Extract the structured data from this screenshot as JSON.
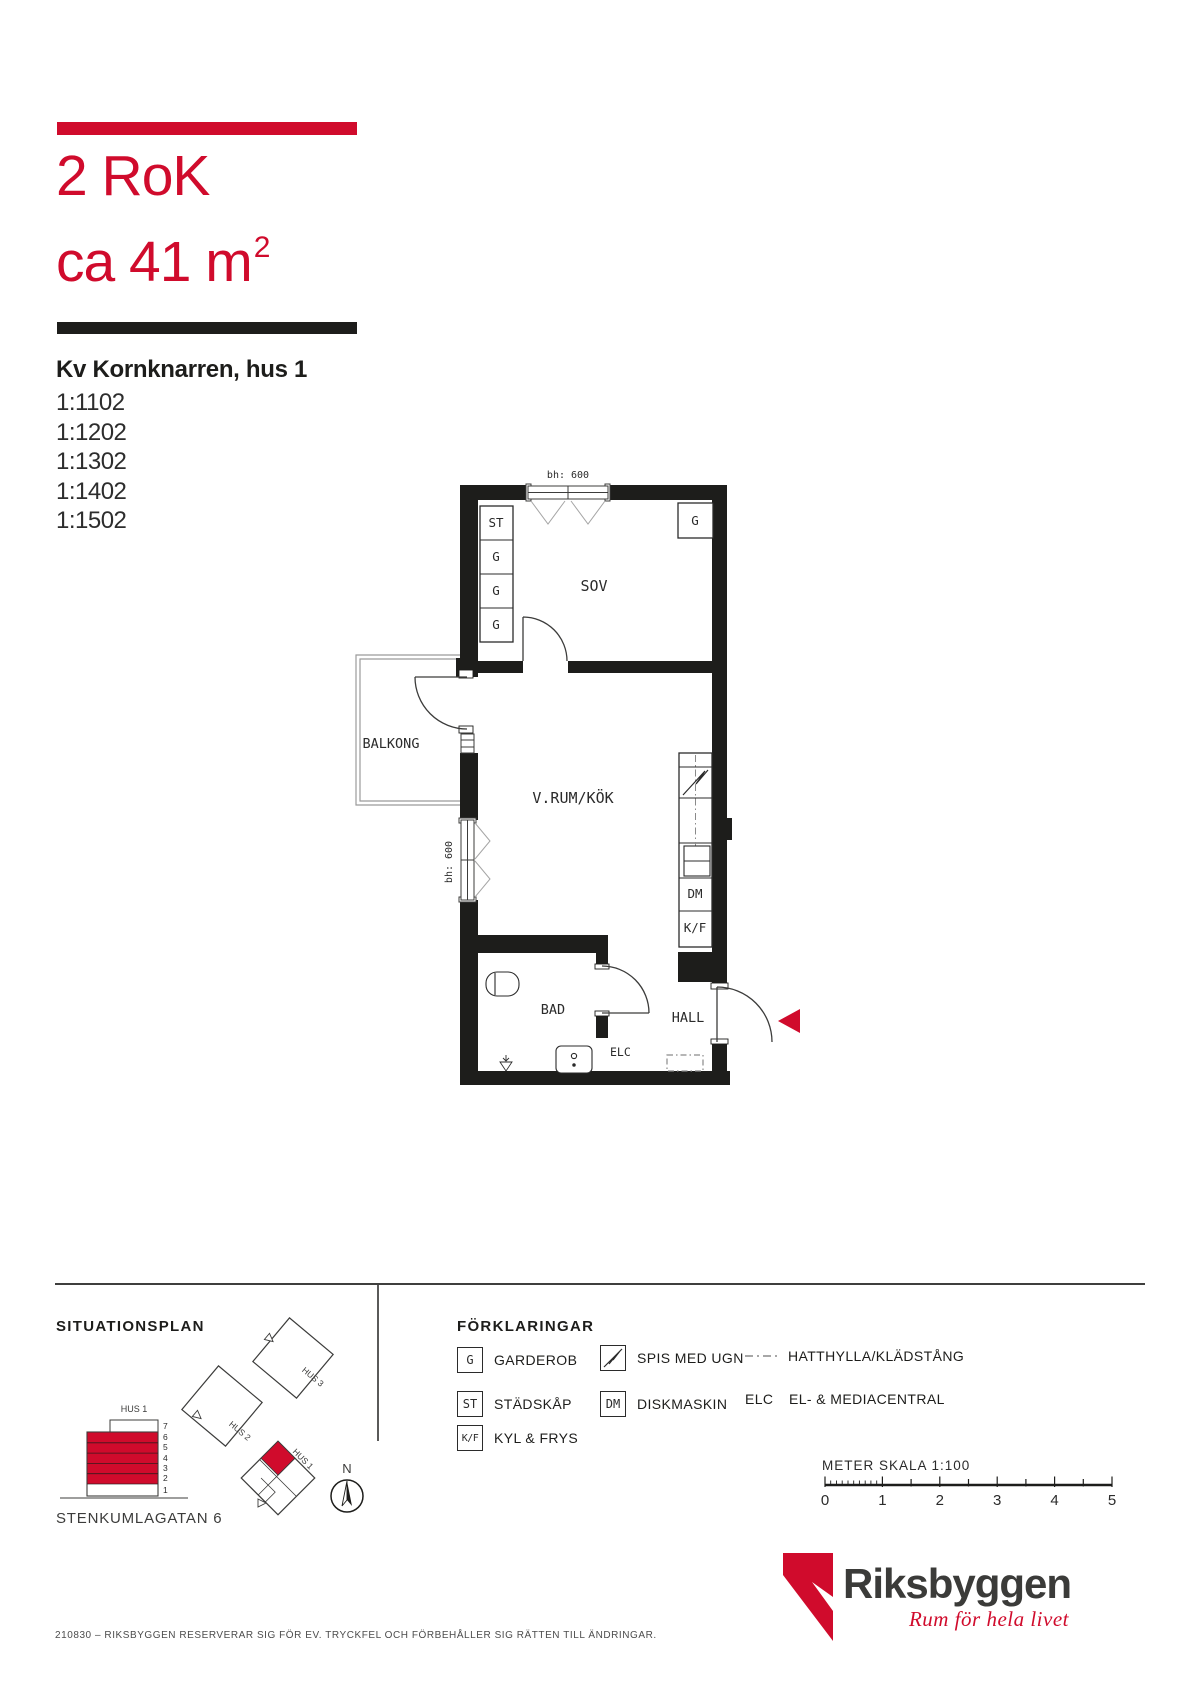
{
  "colors": {
    "red": "#d00b2c",
    "ink": "#1d1d1b"
  },
  "header": {
    "flat_type": "2 RoK",
    "area_line": "ca 41 m",
    "area_sup": "2",
    "block_title": "Kv Kornknarren, hus 1",
    "units": [
      "1:1102",
      "1:1202",
      "1:1302",
      "1:1402",
      "1:1502"
    ]
  },
  "plan": {
    "bh_top": "bh: 600",
    "bh_left": "bh: 600",
    "closets": {
      "st": "ST",
      "g": "G"
    },
    "rooms": {
      "sov": "SOV",
      "vrum": "V.RUM/KÖK",
      "balkong": "BALKONG",
      "bad": "BAD",
      "hall": "HALL"
    },
    "fixtures": {
      "dm": "DM",
      "kf": "K/F",
      "elc": "ELC"
    }
  },
  "situationsplan": {
    "heading": "SITUATIONSPLAN",
    "hus1": "HUS 1",
    "hus2": "HUS 2",
    "hus3": "HUS 3",
    "hus1_site": "HUS 1",
    "floors": [
      "7",
      "6",
      "5",
      "4",
      "3",
      "2",
      "1"
    ],
    "street": "STENKUMLAGATAN 6",
    "north": "N"
  },
  "legend": {
    "heading": "FÖRKLARINGAR",
    "items": [
      {
        "key": "G",
        "label": "GARDEROB"
      },
      {
        "key": "ST",
        "label": "STÄDSKÅP"
      },
      {
        "key": "K/F",
        "label": "KYL & FRYS"
      },
      {
        "key": "",
        "label": "SPIS MED UGN"
      },
      {
        "key": "DM",
        "label": "DISKMASKIN"
      },
      {
        "key": "",
        "label": "HATTHYLLA/KLÄDSTÅNG"
      },
      {
        "key": "ELC",
        "label": "EL- & MEDIACENTRAL"
      }
    ]
  },
  "scalebar": {
    "title": "METER  SKALA 1:100",
    "ticks": [
      "0",
      "1",
      "2",
      "3",
      "4",
      "5"
    ]
  },
  "logo": {
    "brand": "Riksbyggen",
    "tagline": "Rum för hela livet"
  },
  "footer": {
    "note": "210830 – RIKSBYGGEN RESERVERAR SIG FÖR EV. TRYCKFEL OCH FÖRBEHÅLLER SIG RÄTTEN TILL ÄNDRINGAR."
  }
}
